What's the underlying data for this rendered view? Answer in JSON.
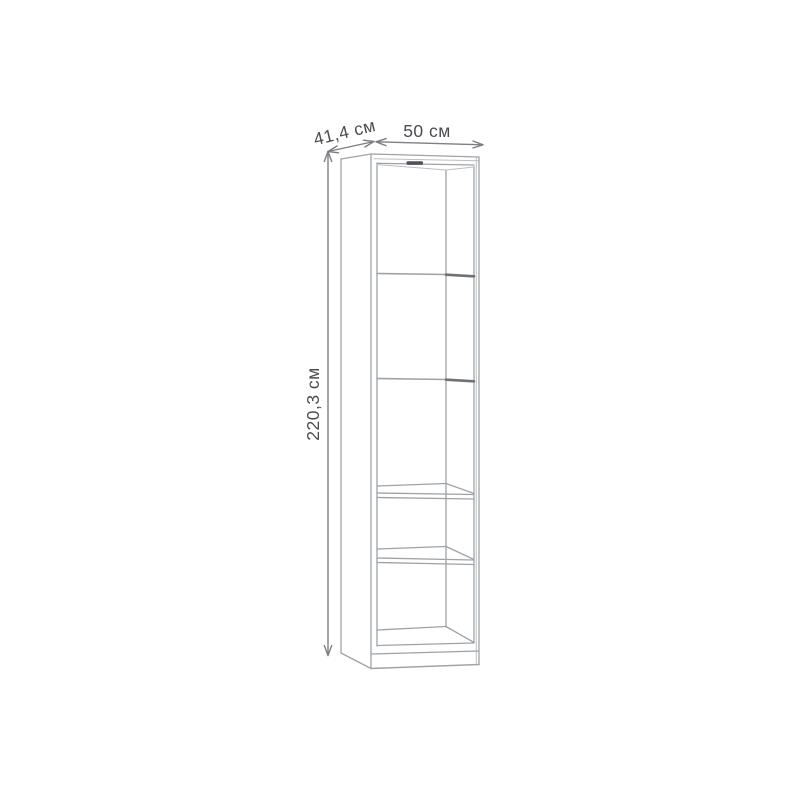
{
  "drawing": {
    "kind": "furniture-dimension-diagram",
    "item": "tall narrow bookcase with five open compartments",
    "labels": {
      "depth": "41,4 см",
      "width": "50 см",
      "height": "220,3 см"
    },
    "colors": {
      "background": "#ffffff",
      "outline": "#9fa3a7",
      "outline_light": "#bcc0c3",
      "shelf_edge_dark": "#6e7276",
      "vent_slot": "#4e5257",
      "dimension": "#7b7f83",
      "label_text": "#4a4d50"
    },
    "compartment_count": 5
  }
}
